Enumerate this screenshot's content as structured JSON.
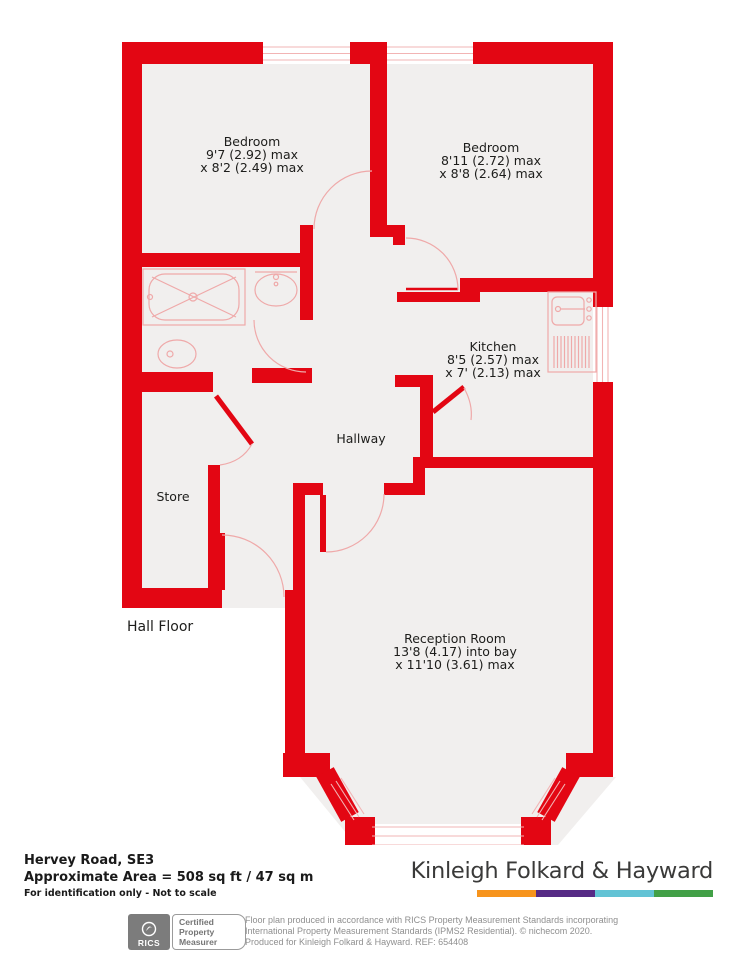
{
  "colors": {
    "wall": "#e30613",
    "floor": "#f1efee",
    "fixture_lines": "#efa9a9",
    "label_text": "#1d1d1b",
    "brand_text": "#3a3a39",
    "smallprint_text": "#8f8f8f",
    "brand_bar_colors": [
      "#f7941d",
      "#562a85",
      "#62c3d5",
      "#42a047"
    ]
  },
  "rooms": {
    "bedroom1": {
      "name": "Bedroom",
      "dim1": "9'7 (2.92) max",
      "dim2": "x 8'2 (2.49) max"
    },
    "bedroom2": {
      "name": "Bedroom",
      "dim1": "8'11 (2.72) max",
      "dim2": "x 8'8 (2.64) max"
    },
    "kitchen": {
      "name": "Kitchen",
      "dim1": "8'5 (2.57) max",
      "dim2": "x 7' (2.13) max"
    },
    "reception": {
      "name": "Reception Room",
      "dim1": "13'8 (4.17) into bay",
      "dim2": "x 11'10 (3.61) max"
    },
    "hallway": {
      "name": "Hallway"
    },
    "store": {
      "name": "Store"
    }
  },
  "floor_label": "Hall Floor",
  "footer": {
    "address": "Hervey Road, SE3",
    "area": "Approximate Area = 508 sq ft / 47 sq m",
    "disclaimer": "For identification only - Not to scale",
    "brand": "Kinleigh Folkard & Hayward"
  },
  "certification": {
    "org": "RICS",
    "line1": "Certified",
    "line2": "Property",
    "line3": "Measurer"
  },
  "smallprint": {
    "line1": "Floor plan produced in accordance with RICS Property Measurement Standards incorporating",
    "line2": "International Property Measurement Standards (IPMS2 Residential).  © nichecom 2020.",
    "line3": "Produced for Kinleigh Folkard & Hayward.  REF: 654408"
  }
}
